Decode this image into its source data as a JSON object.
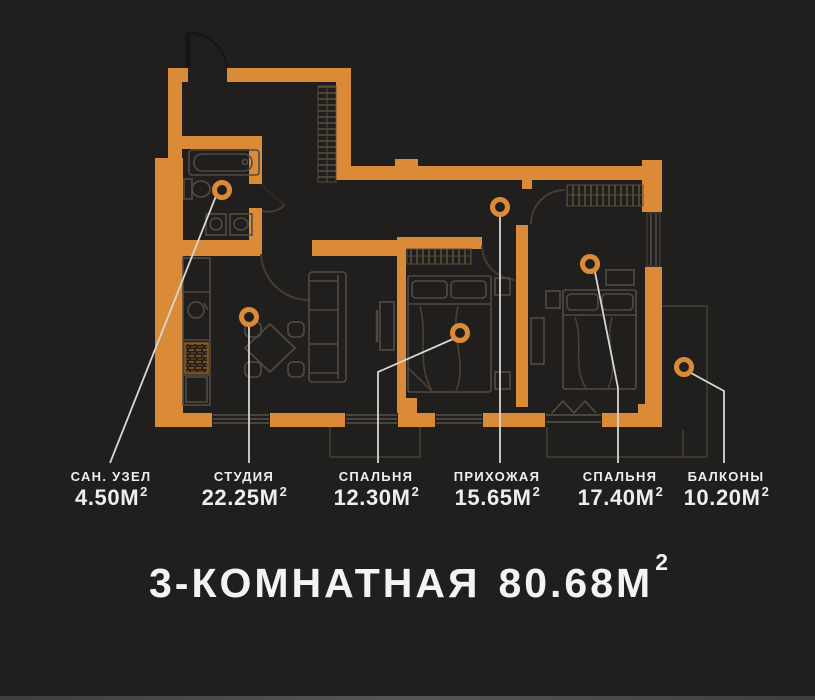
{
  "colors": {
    "background": "#211f1e",
    "wall": "#DB8B38",
    "furniture_line": "#514b42",
    "leader_line": "#d8d6d2",
    "text": "#efeeec",
    "balcony_outline": "#3b3834"
  },
  "floor_plan": {
    "type": "apartment-floor-plan",
    "title": {
      "label": "3-КОМНАТНАЯ",
      "value": "80.68",
      "unit": "М",
      "sup": "2"
    },
    "total_area_m2": 80.68,
    "rooms": [
      {
        "id": "san-uzel",
        "name": "САН. УЗЕЛ",
        "value": "4.50",
        "unit": "М",
        "sup": "2",
        "area_m2": 4.5
      },
      {
        "id": "studio",
        "name": "СТУДИЯ",
        "value": "22.25",
        "unit": "М",
        "sup": "2",
        "area_m2": 22.25
      },
      {
        "id": "bedroom-1",
        "name": "СПАЛЬНЯ",
        "value": "12.30",
        "unit": "М",
        "sup": "2",
        "area_m2": 12.3
      },
      {
        "id": "hallway",
        "name": "ПРИХОЖАЯ",
        "value": "15.65",
        "unit": "М",
        "sup": "2",
        "area_m2": 15.65
      },
      {
        "id": "bedroom-2",
        "name": "СПАЛЬНЯ",
        "value": "17.40",
        "unit": "М",
        "sup": "2",
        "area_m2": 17.4
      },
      {
        "id": "balconies",
        "name": "БАЛКОНЫ",
        "value": "10.20",
        "unit": "М",
        "sup": "2",
        "area_m2": 10.2
      }
    ]
  }
}
